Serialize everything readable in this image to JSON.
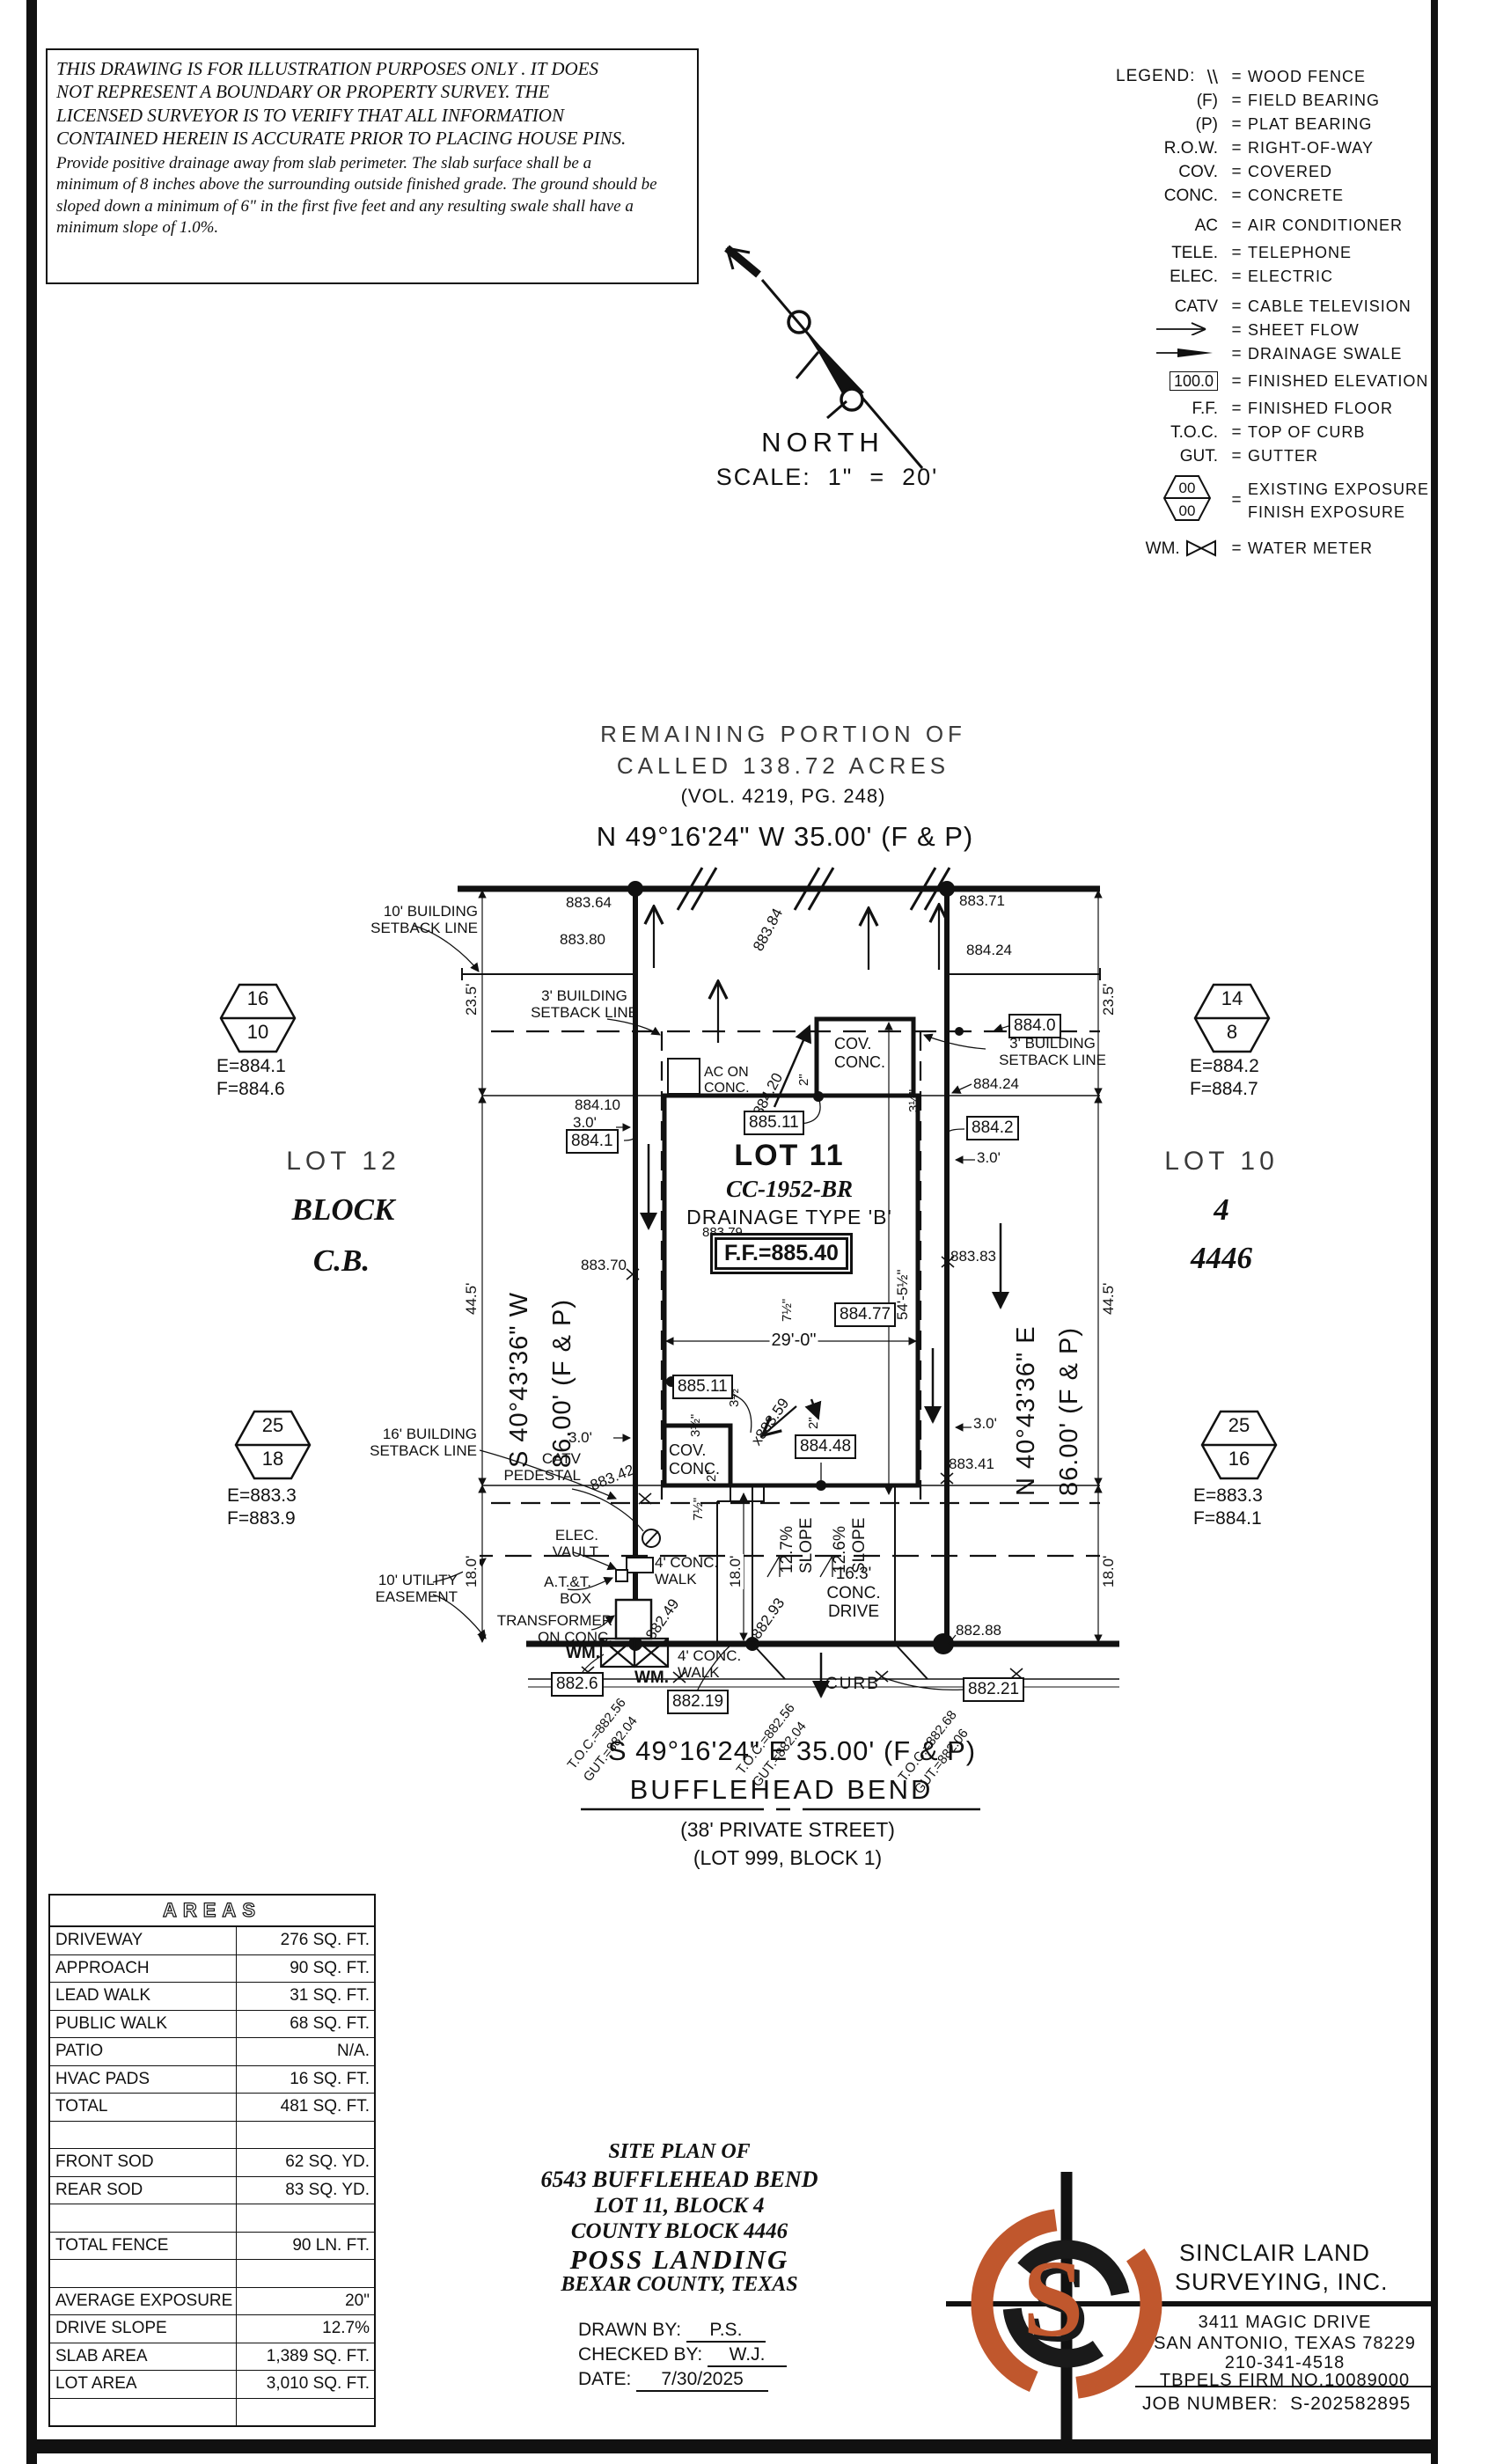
{
  "disclaimer": {
    "para1": "THIS DRAWING IS FOR ILLUSTRATION PURPOSES ONLY . IT DOES\nNOT REPRESENT A BOUNDARY OR PROPERTY SURVEY. THE\nLICENSED SURVEYOR IS TO VERIFY THAT ALL INFORMATION\nCONTAINED HEREIN IS ACCURATE PRIOR TO PLACING HOUSE PINS.",
    "para2": "Provide positive drainage away from slab perimeter. The slab surface shall be a\nminimum of 8 inches above the surrounding outside finished grade. The ground should be\nsloped down a minimum of 6\" in the first five feet and any resulting swale shall have a\nminimum slope of 1.0%."
  },
  "north": {
    "label": "NORTH",
    "scale": "SCALE:  1\"  =  20'"
  },
  "legend": {
    "title": "LEGEND:",
    "wood_fence": {
      "sym": "\\\\",
      "desc": "WOOD FENCE"
    },
    "field_bearing": {
      "sym": "(F)",
      "desc": "FIELD BEARING"
    },
    "plat_bearing": {
      "sym": "(P)",
      "desc": "PLAT BEARING"
    },
    "row": {
      "sym": "R.O.W.",
      "desc": "RIGHT-OF-WAY"
    },
    "cov": {
      "sym": "COV.",
      "desc": "COVERED"
    },
    "conc": {
      "sym": "CONC.",
      "desc": "CONCRETE"
    },
    "ac": {
      "sym": "AC",
      "desc": "AIR CONDITIONER"
    },
    "tele": {
      "sym": "TELE.",
      "desc": "TELEPHONE"
    },
    "elec": {
      "sym": "ELEC.",
      "desc": "ELECTRIC"
    },
    "catv": {
      "sym": "CATV",
      "desc": "CABLE TELEVISION"
    },
    "sheet_flow": {
      "desc": "SHEET FLOW"
    },
    "drainage_swale": {
      "desc": "DRAINAGE SWALE"
    },
    "finished_elevation": {
      "sym": "100.0",
      "desc": "FINISHED ELEVATION"
    },
    "ff": {
      "sym": "F.F.",
      "desc": "FINISHED FLOOR"
    },
    "toc": {
      "sym": "T.O.C.",
      "desc": "TOP OF CURB"
    },
    "gut": {
      "sym": "GUT.",
      "desc": "GUTTER"
    },
    "exposure": {
      "top": "00",
      "bottom": "00",
      "desc": "EXISTING EXPOSURE\nFINISH EXPOSURE"
    },
    "wm": {
      "sym": "WM.",
      "desc": "WATER METER"
    }
  },
  "plat": {
    "header1": "REMAINING PORTION OF",
    "header2": "CALLED 138.72 ACRES",
    "header3": "(VOL. 4219, PG. 248)",
    "bearing_top": "N 49°16'24\" W 35.00' (F & P)",
    "bearing_bottom": "S 49°16'24\" E 35.00' (F & P)",
    "bearing_left": "S 40°43'36\" W\n86.00' (F & P)",
    "bearing_right": "N 40°43'36\" E\n86.00' (F & P)",
    "street_name": "BUFFLEHEAD BEND",
    "street_sub1": "(38' PRIVATE STREET)",
    "street_sub2": "(LOT 999, BLOCK 1)",
    "lot11": "LOT 11",
    "cc": "CC-1952-BR",
    "drainage_type": "DRAINAGE TYPE 'B'",
    "ff": "F.F.=885.40",
    "lot12": "LOT 12",
    "block_word": "BLOCK",
    "block_cb": "C.B.",
    "lot10": "LOT 10",
    "block4": "4",
    "cb4446": "4446",
    "sb10": "10' BUILDING\nSETBACK LINE",
    "sb3l": "3' BUILDING\nSETBACK LINE",
    "sb3r": "3' BUILDING\nSETBACK LINE",
    "sb16": "16' BUILDING\nSETBACK LINE",
    "ue10": "10' UTILITY\nEASEMENT",
    "catv_ped": "CATV\nPEDESTAL",
    "elec_vault": "ELEC.\nVAULT",
    "att_box": "A.T.&T.\nBOX",
    "transformer": "TRANSFORMER\nON CONC.",
    "wm1": "WM.",
    "wm2": "WM.",
    "ac_pad": "AC ON\nCONC.",
    "cov_rear": "COV.\nCONC.",
    "cov_front": "COV.\nCONC.",
    "walk1": "4' CONC.\nWALK",
    "walk2": "4' CONC.\nWALK",
    "drive": "16.3'\nCONC.\nDRIVE",
    "curb": "CURB",
    "slope1": "12.7%\nSLOPE",
    "slope2": "12.6%\nSLOPE",
    "d235l": "23.5'",
    "d235r": "23.5'",
    "d445l": "44.5'",
    "d445r": "44.5'",
    "d180l": "18.0'",
    "d180m": "18.0'",
    "d180r": "18.0'",
    "d30a": "3.0'",
    "d30b": "3.0'",
    "d30c": "3.0'",
    "d30d": "3.0'",
    "d29": "29'-0\"",
    "d545": "54'-5½\"",
    "t2a": "2\"",
    "t2b": "2\"",
    "t2c": "2\"",
    "t35a": "3½\"",
    "t35b": "3½\"",
    "t35c": "3½\"",
    "t75a": "7½\"",
    "t75b": "7½\"",
    "e88364": "883.64",
    "e88380": "883.80",
    "e88371": "883.71",
    "e88424a": "884.24",
    "e88424b": "884.24",
    "e88410": "884.10",
    "e88370": "883.70",
    "e88383": "883.83",
    "e88341": "883.41",
    "e88379": "883.79",
    "e88342": "883.42",
    "e88384": "883.84",
    "e88420": "884.20",
    "e88249": "882.49",
    "e88293": "x882.93",
    "e88359": "x883.59",
    "e88288": "882.88",
    "b8841": "884.1",
    "b88511a": "885.11",
    "b88511b": "885.11",
    "b8840": "884.0",
    "b8842": "884.2",
    "b88477": "884.77",
    "b88448": "884.48",
    "b8826": "882.6",
    "b88219": "882.19",
    "b88221": "882.21",
    "toc_a": "T.O.C.=882.56\nGUT.=882.04",
    "toc_b": "T.O.C.=882.56\nGUT.=882.04",
    "toc_c": "T.O.C.=882.68\nGUT.=882.06",
    "hex_lt": {
      "top": "16",
      "bottom": "10",
      "e": "E=884.1",
      "f": "F=884.6"
    },
    "hex_rt": {
      "top": "14",
      "bottom": "8",
      "e": "E=884.2",
      "f": "F=884.7"
    },
    "hex_lb": {
      "top": "25",
      "bottom": "18",
      "e": "E=883.3",
      "f": "F=883.9"
    },
    "hex_rb": {
      "top": "25",
      "bottom": "16",
      "e": "E=883.3",
      "f": "F=884.1"
    }
  },
  "areas": {
    "title": "AREAS",
    "rows": [
      {
        "label": "DRIVEWAY",
        "value": "276 SQ. FT."
      },
      {
        "label": "APPROACH",
        "value": "90 SQ. FT."
      },
      {
        "label": "LEAD WALK",
        "value": "31 SQ. FT."
      },
      {
        "label": "PUBLIC WALK",
        "value": "68 SQ. FT."
      },
      {
        "label": "PATIO",
        "value": "N/A."
      },
      {
        "label": "HVAC PADS",
        "value": "16 SQ. FT."
      },
      {
        "label": "TOTAL",
        "value": "481 SQ. FT."
      },
      {
        "label": "",
        "value": ""
      },
      {
        "label": "FRONT SOD",
        "value": "62 SQ. YD."
      },
      {
        "label": "REAR SOD",
        "value": "83 SQ. YD."
      },
      {
        "label": "",
        "value": ""
      },
      {
        "label": "TOTAL FENCE",
        "value": "90 LN. FT."
      },
      {
        "label": "",
        "value": ""
      },
      {
        "label": "AVERAGE EXPOSURE",
        "value": "20\""
      },
      {
        "label": "DRIVE SLOPE",
        "value": "12.7%"
      },
      {
        "label": "SLAB AREA",
        "value": "1,389 SQ. FT."
      },
      {
        "label": "LOT AREA",
        "value": "3,010 SQ. FT."
      },
      {
        "label": "",
        "value": ""
      }
    ]
  },
  "titleblock": {
    "l1": "SITE PLAN OF",
    "l2": "6543 BUFFLEHEAD BEND",
    "l3": "LOT 11, BLOCK 4",
    "l4": "COUNTY BLOCK 4446",
    "l5": "POSS LANDING",
    "l6": "BEXAR COUNTY, TEXAS",
    "drawn_label": "DRAWN BY:",
    "drawn": "P.S.",
    "checked_label": "CHECKED BY:",
    "checked": "W.J.",
    "date_label": "DATE:",
    "date": "7/30/2025"
  },
  "firm": {
    "name1": "SINCLAIR LAND",
    "name2": "SURVEYING, INC.",
    "addr1": "3411 MAGIC DRIVE",
    "addr2": "SAN ANTONIO, TEXAS 78229",
    "phone": "210-341-4518",
    "firm_no": "TBPELS FIRM NO.10089000",
    "job": "JOB NUMBER:  S-202582895",
    "logo_letter": "S"
  },
  "colors": {
    "ink": "#111111",
    "orange": "#c0572d"
  }
}
